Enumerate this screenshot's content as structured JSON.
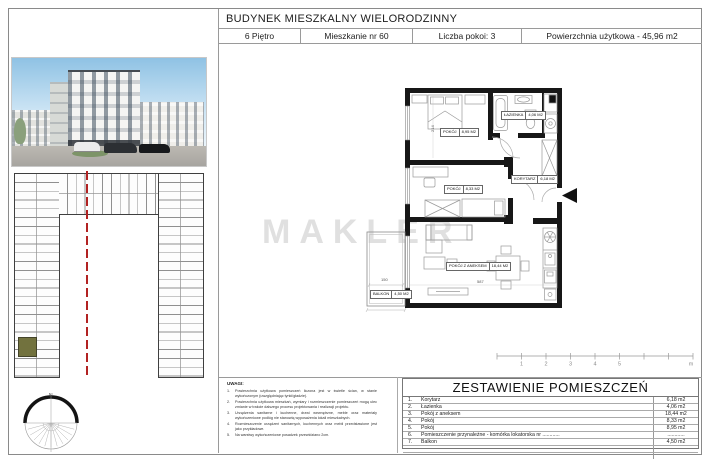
{
  "header": {
    "title": "BUDYNEK MIESZKALNY WIELORODZINNY",
    "cells": [
      {
        "label": "6 Piętro"
      },
      {
        "label": "Mieszkanie nr 60"
      },
      {
        "label": "Liczba pokoi: 3"
      },
      {
        "label": "Powierzchnia użytkowa - 45,96 m2"
      }
    ]
  },
  "watermark": "MAKLER",
  "plan": {
    "rooms": [
      {
        "name": "POKÓJ",
        "area": "8,95 M2"
      },
      {
        "name": "ŁAZIENKA",
        "area": "4,06 M2"
      },
      {
        "name": "KORYTARZ",
        "area": "6,18 M2"
      },
      {
        "name": "POKÓJ",
        "area": "8,33 M2"
      },
      {
        "name": "POKÓJ Z ANEKSEM",
        "area": "18,44 M2"
      },
      {
        "name": "BALKON",
        "area": "4,50 M2"
      }
    ],
    "dimensions": {
      "balcony_width": "150",
      "living_width": "587",
      "bedroom_depth": "214"
    },
    "compass_north": "N"
  },
  "scale_bar": {
    "labels": [
      "1",
      "2",
      "3",
      "4",
      "5"
    ],
    "unit": "m"
  },
  "notes": {
    "title": "UWAGI:",
    "items": [
      {
        "no": "1.",
        "text": "Powierzchnia użytkowa pomieszczeń liczona jest w świetle ścian, w stanie wykończonym (uwzględniając tynki/gładzie)."
      },
      {
        "no": "2.",
        "text": "Powierzchnia użytkowa mieszkań, wymiary i rozmieszczenie pomieszczeń mogą ulec zmianie w trakcie dalszego procesu projektowania i realizacji projektu."
      },
      {
        "no": "3.",
        "text": "Urządzenia sanitarne i kuchenne, drzwi wewnętrzne, meble oraz materiały wykończeniowe podłóg nie stanowią wyposażenia lokali mieszkalnych."
      },
      {
        "no": "4.",
        "text": "Rozmieszczenie urządzeń sanitarnych, kuchennych oraz mebli przedstawione jest jako przykładowe."
      },
      {
        "no": "5.",
        "text": "Na warstwy wykończeniowe posadzek przewidziano 2cm."
      }
    ]
  },
  "room_table": {
    "title": "ZESTAWIENIE POMIESZCZEŃ",
    "rows": [
      {
        "no": "1.",
        "name": "Korytarz",
        "area": "6,18 m2"
      },
      {
        "no": "2.",
        "name": "Łazienka",
        "area": "4,06 m2"
      },
      {
        "no": "3.",
        "name": "Pokój z aneksem",
        "area": "18,44 m2"
      },
      {
        "no": "4.",
        "name": "Pokój",
        "area": "8,33 m2"
      },
      {
        "no": "5.",
        "name": "Pokój",
        "area": "8,95 m2"
      },
      {
        "no": "6.",
        "name": "Pomieszczenie przynależne - komórka lokatorska nr ............",
        "area": "............"
      },
      {
        "no": "7.",
        "name": "Balkon",
        "area": "4,50 m2"
      }
    ]
  }
}
